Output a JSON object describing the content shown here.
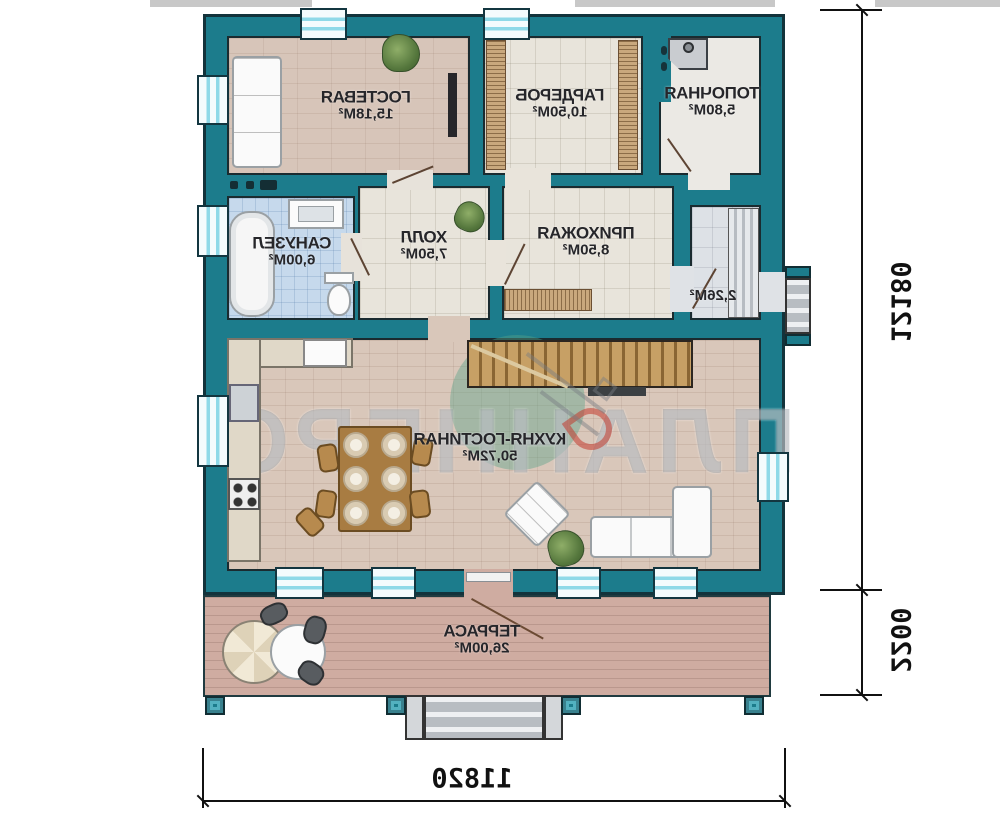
{
  "plan": {
    "rooms": {
      "guest": {
        "name": "ГОСТЕВАЯ",
        "area": "15,18М²"
      },
      "wardrobe": {
        "name": "ГАРДЕРОБ",
        "area": "10,50М²"
      },
      "boiler": {
        "name": "ТОПОЧНАЯ",
        "area": "5,80М²"
      },
      "bathroom": {
        "name": "САНУЗЕЛ",
        "area": "6,00М²"
      },
      "hall": {
        "name": "ХОЛЛ",
        "area": "7,50М²"
      },
      "entry": {
        "name": "ПРИХОЖАЯ",
        "area": "8,50М²"
      },
      "vestibule": {
        "area": "2,26М²"
      },
      "kitchen": {
        "name": "КУХНЯ-ГОСТИНАЯ",
        "area": "50,72М²"
      },
      "terrace": {
        "name": "ТЕРРАСА",
        "area": "26,00М²"
      }
    },
    "dimensions": {
      "height_total": "12180",
      "terrace_depth": "2200",
      "width_total": "11820"
    },
    "watermark": {
      "text": "ПЛАННЕРС"
    },
    "colors": {
      "wall_teal": "#1c7c8c",
      "window_cyan": "#8fd9e8",
      "terrace_wood": "#cfaca1",
      "bath_tile": "#c6d9ec",
      "logo_red": "#c23b2e",
      "logo_green": "#57a387"
    }
  }
}
